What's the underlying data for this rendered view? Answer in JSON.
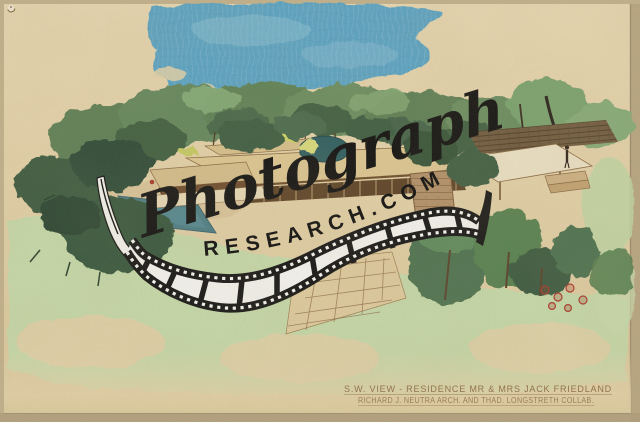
{
  "image": {
    "kind": "scanned photograph of a watercolor architectural rendering on tan paper",
    "subject": "Aerial southwest view of a modernist flat-roofed residence with swimming pool, lawn and trees"
  },
  "watermark": {
    "script_text": "Photograph",
    "arc_text": "RESEARCH.COM"
  },
  "caption": {
    "line1": "S.W. VIEW - RESIDENCE MR & MRS JACK FRIEDLAND",
    "line2": "RICHARD J. NEUTRA ARCH. AND THAD. LONGSTRETH COLLAB."
  },
  "palette": {
    "paper": "#e3d2aa",
    "paper_edge": "#c7b592",
    "sky_blue": "#58a3c4",
    "tree_dark": "#33523a",
    "tree_mid": "#5e8157",
    "tree_light": "#8ab07a",
    "lawn_green": "#c5d9a9",
    "pool_teal": "#4b7d85",
    "roof_tan": "#ddc793",
    "shadow_brown": "#5c4226",
    "stone": "#b2916a",
    "accent_red": "#a8392b",
    "caption_ink": "#85643e",
    "film_black": "#151515",
    "film_white": "#f4f4f0"
  }
}
